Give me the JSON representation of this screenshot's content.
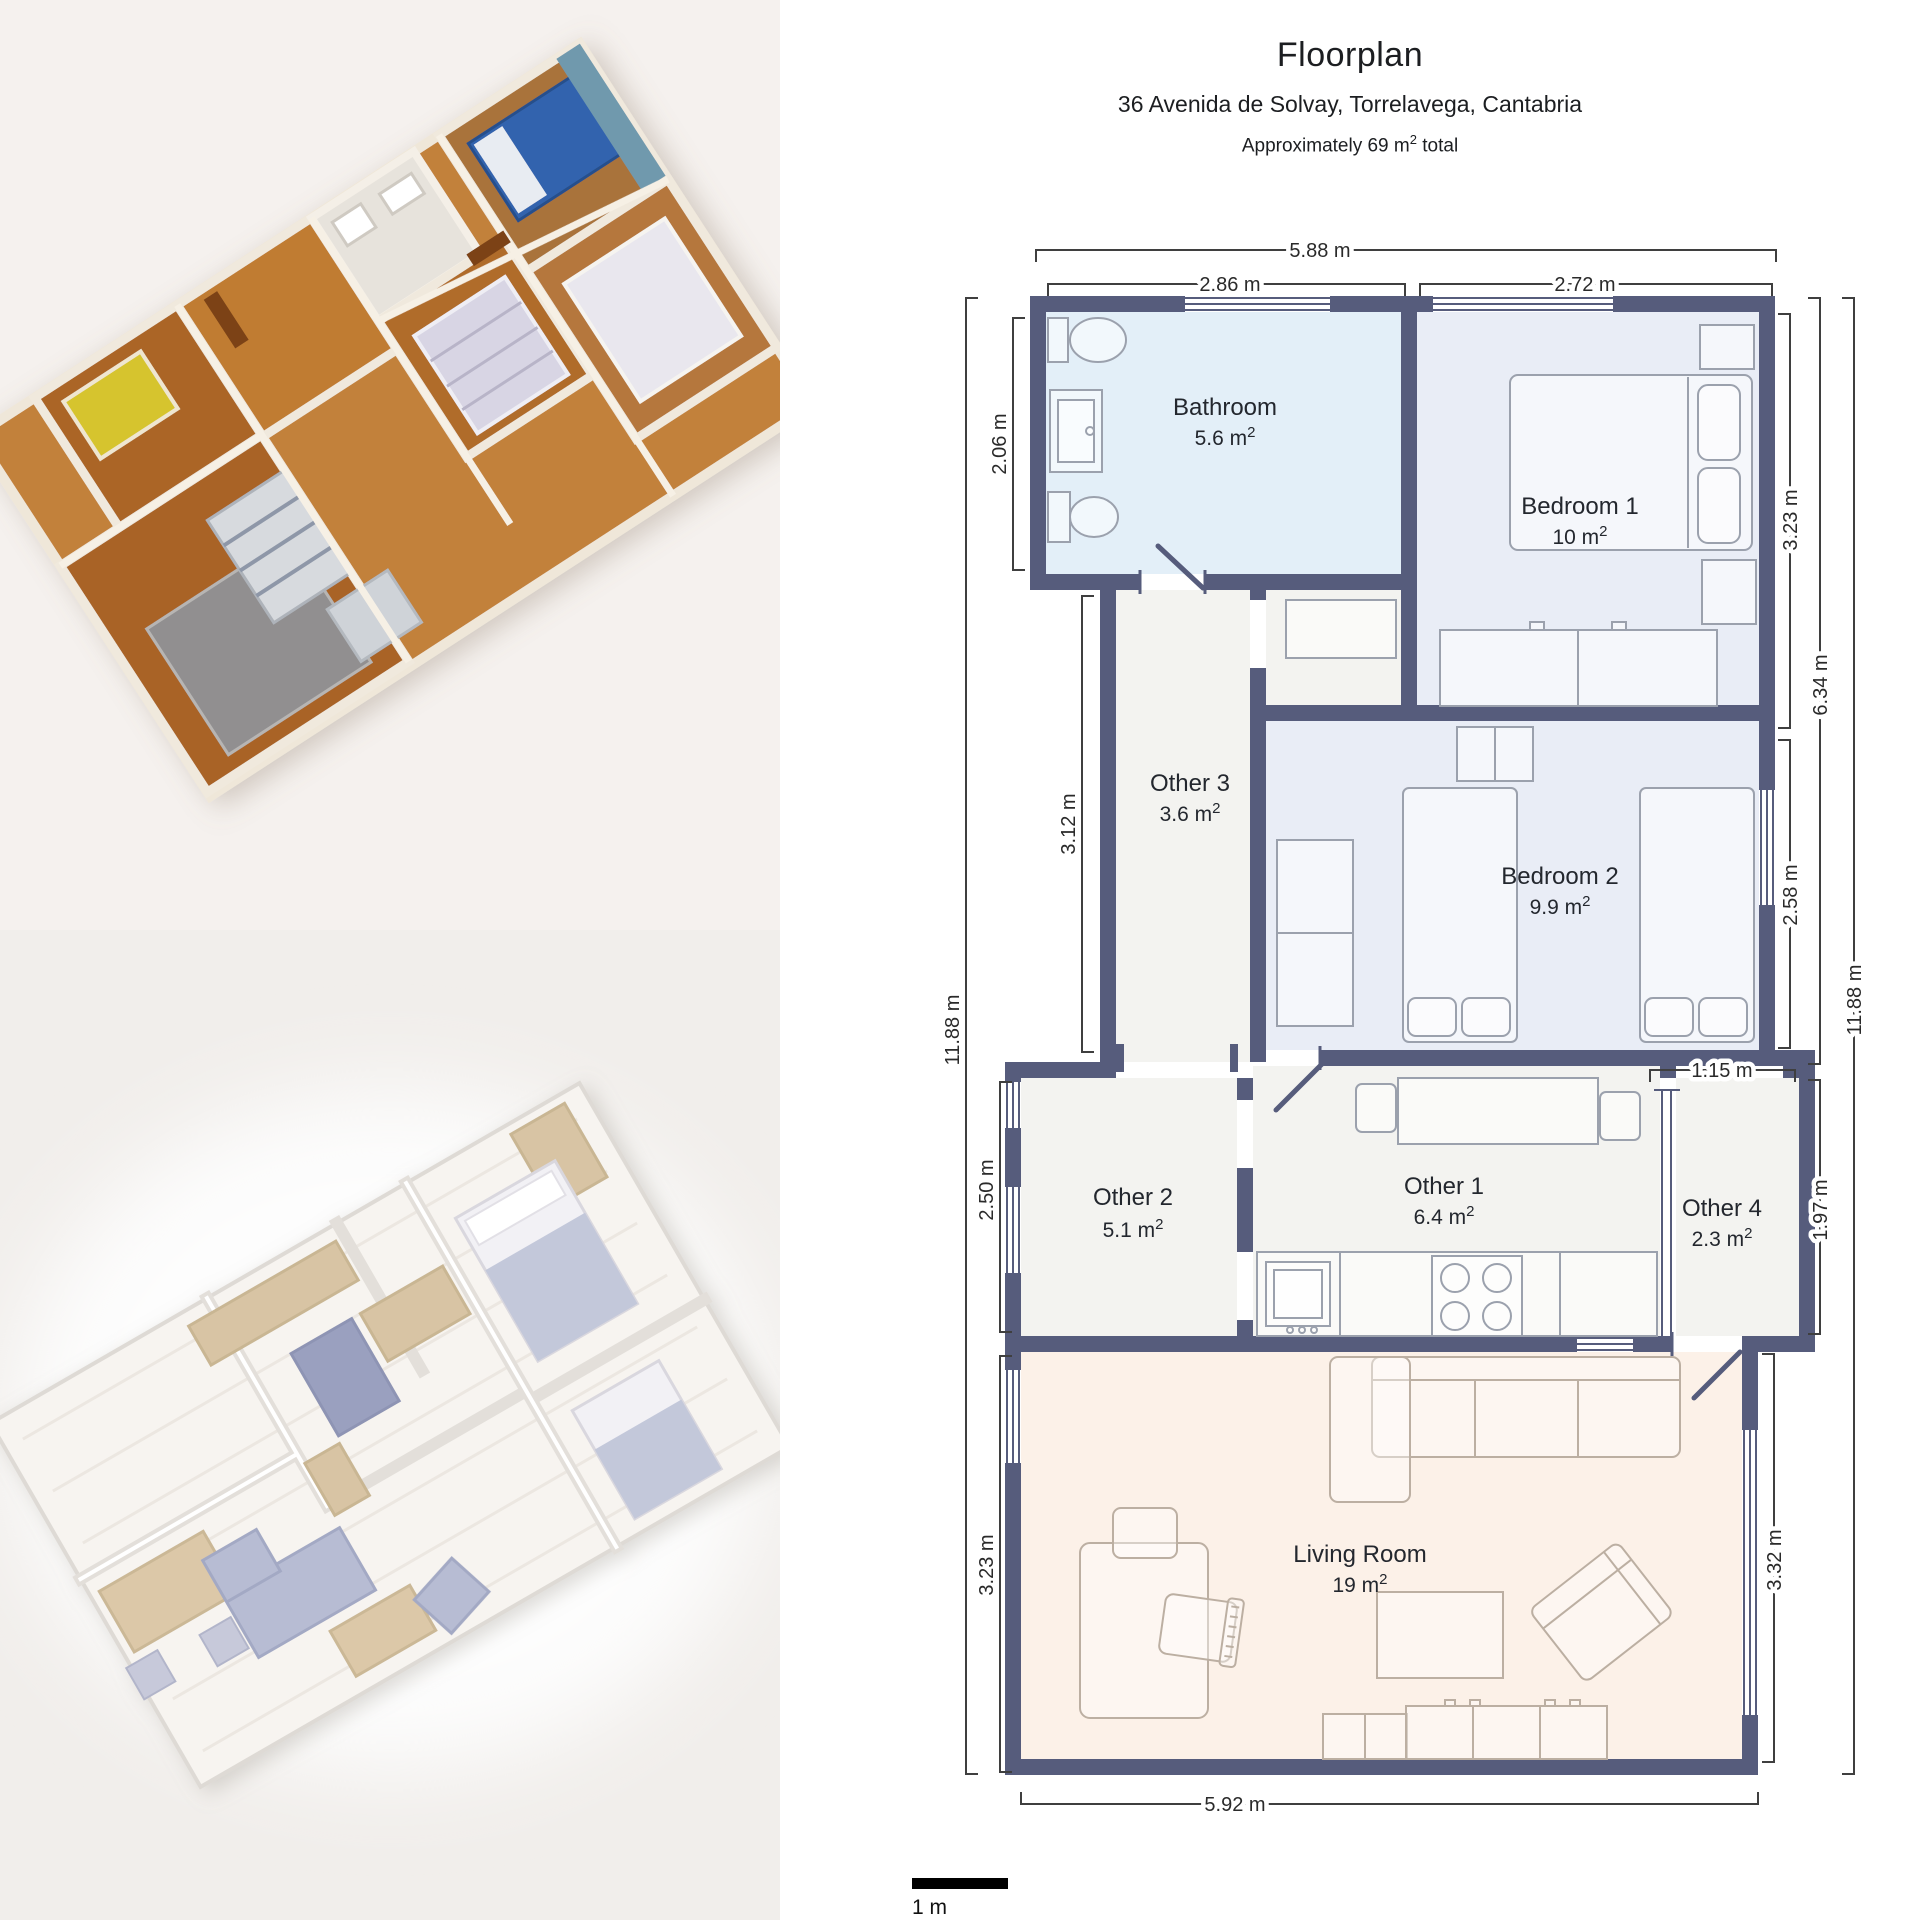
{
  "header": {
    "title": "Floorplan",
    "address": "36 Avenida de Solvay, Torrelavega, Cantabria",
    "area_prefix": "Approximately 69 m",
    "area_sup": "2",
    "area_suffix": " total"
  },
  "floorplan": {
    "rooms": [
      {
        "id": "bathroom",
        "name": "Bathroom",
        "area": "5.6 m",
        "sup": "2"
      },
      {
        "id": "bedroom-1",
        "name": "Bedroom 1",
        "area": "10 m",
        "sup": "2"
      },
      {
        "id": "other-3",
        "name": "Other 3",
        "area": "3.6 m",
        "sup": "2"
      },
      {
        "id": "bedroom-2",
        "name": "Bedroom 2",
        "area": "9.9 m",
        "sup": "2"
      },
      {
        "id": "other-2",
        "name": "Other 2",
        "area": "5.1 m",
        "sup": "2"
      },
      {
        "id": "other-1",
        "name": "Other 1",
        "area": "6.4 m",
        "sup": "2"
      },
      {
        "id": "other-4",
        "name": "Other 4",
        "area": "2.3 m",
        "sup": "2"
      },
      {
        "id": "living-room",
        "name": "Living Room",
        "area": "19 m",
        "sup": "2"
      }
    ],
    "dims": {
      "top_total": "5.88 m",
      "top_left": "2.86 m",
      "top_right": "2.72 m",
      "bath_h": "2.06 m",
      "other3_h": "3.12 m",
      "left_total": "11.88 m",
      "other2_h": "2.50 m",
      "living_h_left": "3.23 m",
      "bed1_h": "3.23 m",
      "right_upper": "6.34 m",
      "bed2_h": "2.58 m",
      "right_total": "11.88 m",
      "other4_w": "1.15 m",
      "other4_h": "1.97 m",
      "living_h_right": "3.32 m",
      "bottom": "5.92 m"
    },
    "scale_label": "1 m"
  },
  "colors": {
    "wall": "#565c7c",
    "bathroom_fill": "#e3eff8",
    "bedroom_fill": "#e9edf6",
    "other_fill": "#f3f3f0",
    "living_fill": "#fcf1e8",
    "dimension_line": "#3f3f3f",
    "scale_bar": "#000000",
    "left_bg_top": "#f5f1ee",
    "left_bg_bottom": "#f1eeeb"
  }
}
